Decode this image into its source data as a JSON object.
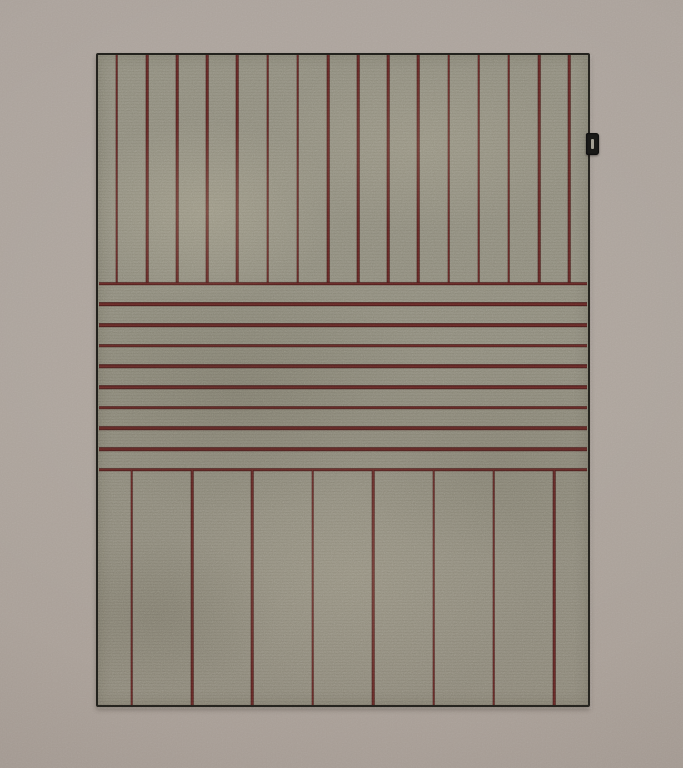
{
  "scene": {
    "subject": "Flat-woven striped area rug photographed straight-on against a plain taupe wall",
    "tag": {
      "description": "small black fabric brand tag protruding from the right edge",
      "label": ""
    }
  },
  "colors": {
    "wall": "#aba29a",
    "rug_base": "#8e8b7c",
    "stripe_core": "#6b2b28",
    "stripe_edge": "#3e1716",
    "rug_edge_border": "#23221d",
    "tag": "#1a1a18",
    "tag_mark": "#c7c2b4"
  },
  "rug": {
    "sections": [
      {
        "name": "top",
        "stripe_orientation": "vertical",
        "stripe_count": 16,
        "height_pct": 35.2,
        "edge_inset_pct": 3.85,
        "stripe_thickness_px": 2.6
      },
      {
        "name": "middle",
        "stripe_orientation": "horizontal",
        "stripe_count": 10,
        "height_pct": 28.6,
        "edge_inset_pct": 0,
        "stripe_thickness_px": 3.6
      },
      {
        "name": "bottom",
        "stripe_orientation": "vertical",
        "stripe_count": 8,
        "height_pct": 36.2,
        "edge_inset_pct": 6.9,
        "stripe_thickness_px": 2.6
      }
    ]
  }
}
